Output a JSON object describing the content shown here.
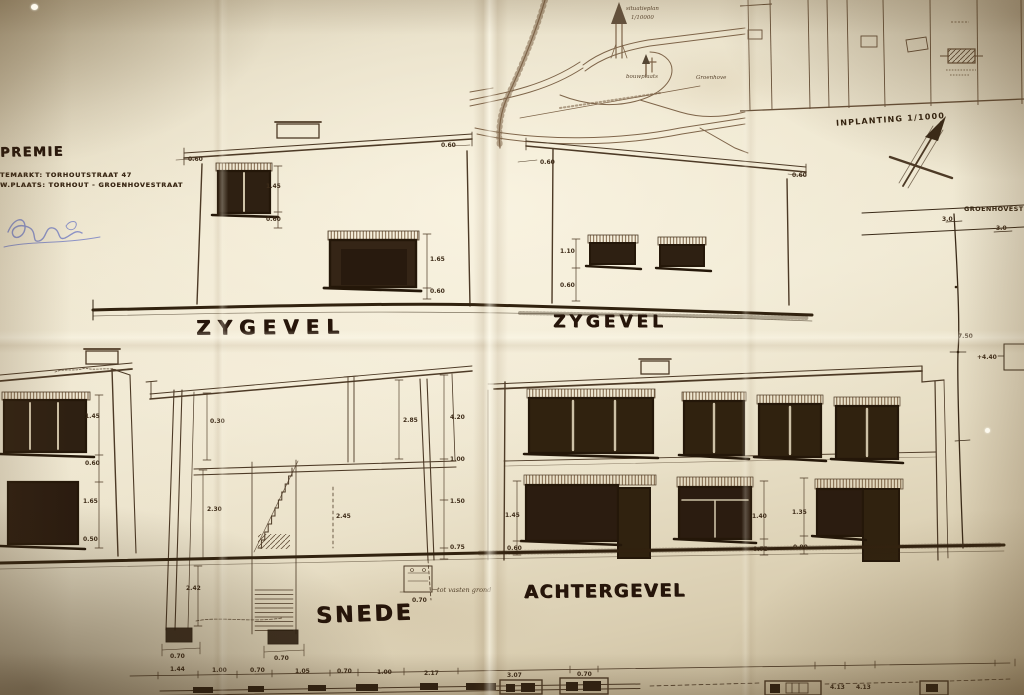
{
  "header": {
    "title": "PREMIE",
    "address_line1": "TEMARKT: TORHOUTSTRAAT 47",
    "address_line2": "W.PLAATS: TORHOUT - GROENHOVESTRAAT"
  },
  "labels": {
    "zygevel_left": "ZYGEVEL",
    "zygevel_right": "ZYGEVEL",
    "snede": "SNEDE",
    "achtergevel": "ACHTERGEVEL",
    "inplanting": "INPLANTING 1/1000",
    "street": "GROENHOVESTRAAT"
  },
  "colors": {
    "paper": "#ece4cc",
    "paper_edge": "#c4b697",
    "ink": "#4d3a26",
    "ink_dark": "#241709",
    "ink_bold": "#26150a",
    "blue_ink": "#7b84c4"
  },
  "annotations": [
    {
      "t": "0.60",
      "x": 188,
      "y": 156
    },
    {
      "t": "0.60",
      "x": 441,
      "y": 142
    },
    {
      "t": "1.45",
      "x": 266,
      "y": 183
    },
    {
      "t": "0.60",
      "x": 266,
      "y": 216
    },
    {
      "t": "1.65",
      "x": 430,
      "y": 256
    },
    {
      "t": "0.60",
      "x": 430,
      "y": 288
    },
    {
      "t": "0.60",
      "x": 540,
      "y": 159
    },
    {
      "t": "0.60",
      "x": 792,
      "y": 172
    },
    {
      "t": "1.10",
      "x": 560,
      "y": 248
    },
    {
      "t": "0.60",
      "x": 560,
      "y": 282
    },
    {
      "t": "1.45",
      "x": 85,
      "y": 413
    },
    {
      "t": "0.60",
      "x": 85,
      "y": 460
    },
    {
      "t": "1.65",
      "x": 83,
      "y": 498
    },
    {
      "t": "0.50",
      "x": 83,
      "y": 536
    },
    {
      "t": "0.30",
      "x": 210,
      "y": 418
    },
    {
      "t": "2.30",
      "x": 207,
      "y": 506
    },
    {
      "t": "2.85",
      "x": 403,
      "y": 417
    },
    {
      "t": "4.20",
      "x": 450,
      "y": 414
    },
    {
      "t": "1.00",
      "x": 450,
      "y": 456
    },
    {
      "t": "1.50",
      "x": 450,
      "y": 498
    },
    {
      "t": "0.75",
      "x": 450,
      "y": 544
    },
    {
      "t": "2.45",
      "x": 336,
      "y": 513
    },
    {
      "t": "2.42",
      "x": 186,
      "y": 585
    },
    {
      "t": "0.70",
      "x": 170,
      "y": 653
    },
    {
      "t": "0.70",
      "x": 274,
      "y": 655
    },
    {
      "t": "tot vasten grond",
      "x": 437,
      "y": 586,
      "c": "hand"
    },
    {
      "t": "0.70",
      "x": 412,
      "y": 597
    },
    {
      "t": "1.45",
      "x": 505,
      "y": 512
    },
    {
      "t": "0.60",
      "x": 507,
      "y": 545
    },
    {
      "t": "1.40",
      "x": 752,
      "y": 513
    },
    {
      "t": "0.75",
      "x": 753,
      "y": 546
    },
    {
      "t": "1.35",
      "x": 792,
      "y": 509
    },
    {
      "t": "0.90",
      "x": 793,
      "y": 544
    },
    {
      "t": "3.0",
      "x": 942,
      "y": 216
    },
    {
      "t": "3.0",
      "x": 996,
      "y": 225
    },
    {
      "t": "7.50",
      "x": 958,
      "y": 333
    },
    {
      "t": "+4.40",
      "x": 977,
      "y": 354
    },
    {
      "t": "1.44",
      "x": 170,
      "y": 666
    },
    {
      "t": "1.00",
      "x": 212,
      "y": 667
    },
    {
      "t": "0.70",
      "x": 250,
      "y": 667
    },
    {
      "t": "1.05",
      "x": 295,
      "y": 668
    },
    {
      "t": "0.70",
      "x": 337,
      "y": 668
    },
    {
      "t": "1.00",
      "x": 377,
      "y": 669
    },
    {
      "t": "2.17",
      "x": 424,
      "y": 670
    },
    {
      "t": "3.07",
      "x": 507,
      "y": 672
    },
    {
      "t": "0.70",
      "x": 577,
      "y": 671
    },
    {
      "t": "4.13",
      "x": 830,
      "y": 684
    },
    {
      "t": "4.13",
      "x": 856,
      "y": 684
    },
    {
      "t": "situatieplan",
      "x": 626,
      "y": 6,
      "c": "tiny"
    },
    {
      "t": "1/10000",
      "x": 631,
      "y": 15,
      "c": "tiny"
    },
    {
      "t": "bouwplaats",
      "x": 626,
      "y": 74,
      "c": "tiny"
    },
    {
      "t": "Groenhove",
      "x": 696,
      "y": 75,
      "c": "tiny"
    }
  ]
}
